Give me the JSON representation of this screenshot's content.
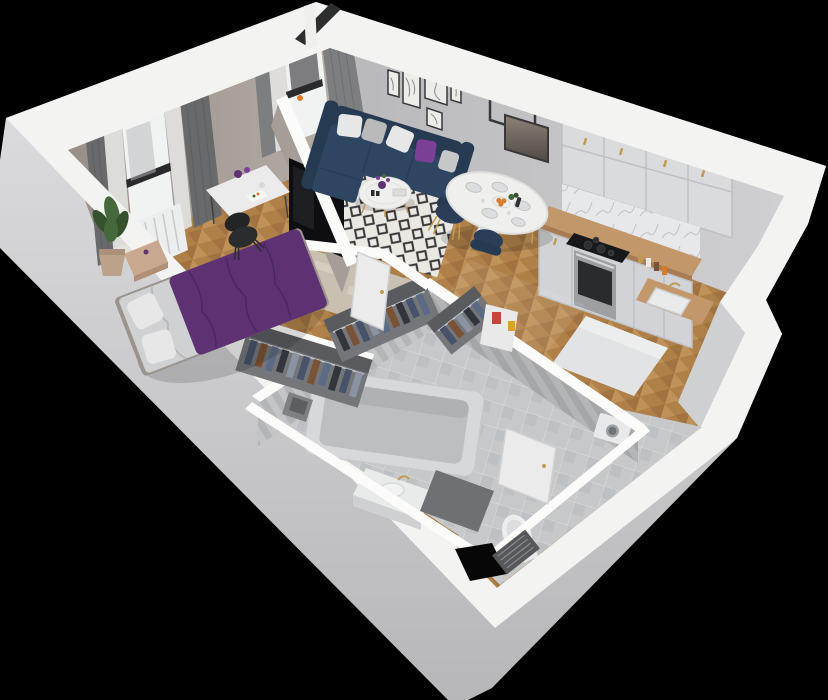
{
  "palette": {
    "bg": "#000000",
    "wall_top": "#f3f3f1",
    "wall_top_bright": "#fbfbfa",
    "wall_outer_light": "#e2e2e4",
    "wall_outer_dark": "#b7b7ba",
    "wall_inner_warm": "#b6afa8",
    "wall_inner_warm_dark": "#978f88",
    "wall_inner_gray": "#d0d0d2",
    "wall_inner_gray_dark": "#b8b8bb",
    "niche_gray": "#cfd0d2",
    "partition_face": "#a59e98",
    "wood_base": "#b08049",
    "wood_light": "#c79c63",
    "wood_dark": "#95673a",
    "rug_bg": "#eae8e3",
    "rug_dark": "#39393b",
    "rug_beige": "#c9c0b1",
    "rug_beige_light": "#ded7c8",
    "tile_floor": "#c6c8ca",
    "tile_floor_dark": "#aeb0b3",
    "tile_wall": "#b3b5b7",
    "tile_wall_light": "#c3c5c7",
    "mat_dark": "#6e7073",
    "marble": "#e7e8e9",
    "marble_vein": "#c2c3c6",
    "counter_wood": "#c2976a",
    "counter_edge": "#a87c52",
    "cabinet_white": "#dadbdd",
    "cabinet_front": "#d2d3d6",
    "cabinet_line": "#bfc0c3",
    "cooktop": "#17181a",
    "burner": "#2e2f31",
    "oven_steel": "#9da0a3",
    "oven_glass": "#2a2b2e",
    "navy": "#2e4661",
    "navy_dark": "#263a52",
    "navy_chair": "#2c3e57",
    "purple": "#5e3173",
    "purple_dark": "#4b2660",
    "purple_pillow": "#7c3f96",
    "sheet": "#d0d1d3",
    "pillow_white": "#e7e7e8",
    "table_white": "#efefee",
    "gold": "#c19a52",
    "tv_black": "#0e0e10",
    "chair_black": "#2b2c2e",
    "plant_green": "#46693c",
    "plant_green_dark": "#35522d",
    "pot_tan": "#bba289",
    "bench_tan": "#c8a88e",
    "desk_white": "#ebebec",
    "door_white": "#ebebec",
    "door_edge": "#cfd0d2",
    "frame_dark": "#38383a",
    "art_bg": "#ecece9",
    "art_line": "#8a8a8c",
    "mirror_top": "#8d8277",
    "mirror_bot": "#4e4a44",
    "curtain_gray": "#7d7e80",
    "curtain_dark": "#68696b",
    "sheer": "#e2e2e0",
    "glass_white": "#f1f2f2",
    "window_bar": "#2a2a2c",
    "balcony_dark": "#2d2e30",
    "post_white": "#efefed",
    "tub_outer": "#d6d8d9",
    "tub_inner": "#bcbfc1",
    "tub_shade": "#aaadaf",
    "ceramic": "#eceded",
    "seat_gray": "#dcdddf",
    "sink_white": "#e9eaea",
    "peninsula_white": "#e2e3e5",
    "peninsula_top": "#eceded",
    "washer_white": "#e8e9ea",
    "washer_door": "#9aa0a4",
    "washer_door_dark": "#6d7276",
    "clothes_navy": "#46536b",
    "clothes_denim": "#5b6b85",
    "clothes_brown": "#7a5236",
    "clothes_dark": "#33353c",
    "clothes_gray": "#8b93a3",
    "closet_back": "#74767a",
    "closet_dark": "#595b5f",
    "rail_light": "#c9cacc",
    "shelf_white": "#e9e9ea",
    "box_red": "#c4453c",
    "box_white": "#ece9e6",
    "box_yellow": "#d9a327",
    "basket": "#7e8083",
    "basket_dark": "#5c5e61",
    "duct": "#8a8a8d",
    "duct_dark": "#6e6e71",
    "entrance_black": "#070707",
    "grate_dark": "#55575a",
    "grate_line": "#8a8c8f",
    "orange": "#d97b28",
    "shadow": "rgba(0,0,0,0.14)",
    "sun": "#ffffff"
  }
}
